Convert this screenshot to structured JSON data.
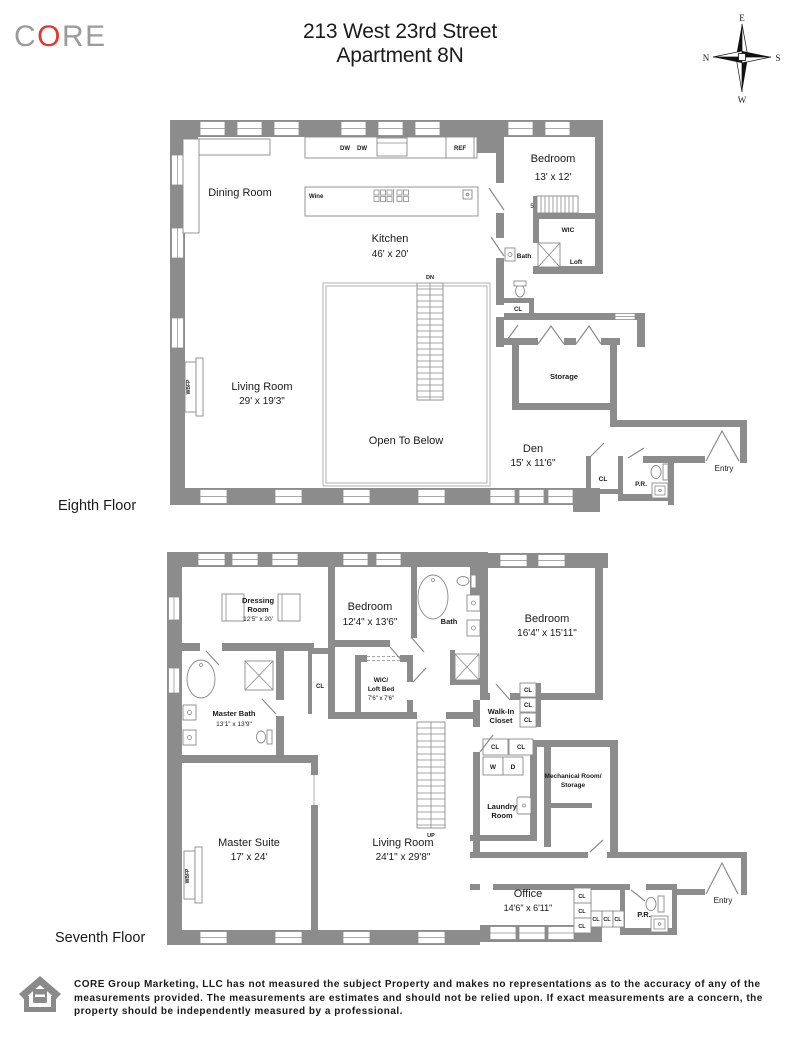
{
  "header": {
    "logo": {
      "c": "C",
      "o": "O",
      "re": "RE"
    },
    "title_line1": "213 West 23rd Street",
    "title_line2": "Apartment 8N",
    "compass": {
      "top": "E",
      "left": "N",
      "right": "S",
      "bottom": "W"
    }
  },
  "colors": {
    "logo_red": "#e0382e",
    "logo_gray": "#9b9b9b",
    "wall_gray": "#8c8c8c"
  },
  "floor8": {
    "name": "Eighth Floor",
    "dining": "Dining Room",
    "kitchen": "Kitchen",
    "kitchen_dims": "46' x 20'",
    "bedroom": "Bedroom",
    "bedroom_dims": "13' x 12'",
    "living": "Living Room",
    "living_dims": "29' x 19'3\"",
    "open_to_below": "Open To Below",
    "den": "Den",
    "den_dims": "15' x 11'6\"",
    "storage": "Storage",
    "wic": "WIC",
    "bath": "Bath",
    "loft": "Loft",
    "cl": "CL",
    "pr": "P.R.",
    "entry": "Entry",
    "dw": "DW",
    "ref": "REF",
    "wine": "Wine",
    "dn": "DN",
    "steps": "5",
    "wbfp": "WBFP"
  },
  "floor7": {
    "name": "Seventh Floor",
    "dressing_line1": "Dressing",
    "dressing_line2": "Room",
    "dressing_dims": "12'5\" x 20'",
    "master_bath": "Master Bath",
    "master_bath_dims": "13'1\" x 13'9\"",
    "bedroom_mid": "Bedroom",
    "bedroom_mid_dims": "12'4\" x 13'6\"",
    "wic_line1": "WIC/",
    "wic_line2": "Loft Bed",
    "wic_dims": "7'6\" x 7'6\"",
    "bath": "Bath",
    "bedroom_right": "Bedroom",
    "bedroom_right_dims": "16'4\" x 15'11\"",
    "walk_in_line1": "Walk-In",
    "walk_in_line2": "Closet",
    "cl": "CL",
    "w": "W",
    "d": "D",
    "laundry_line1": "Laundry",
    "laundry_line2": "Room",
    "mech_line1": "Mechanical Room/",
    "mech_line2": "Storage",
    "master_suite": "Master Suite",
    "master_suite_dims": "17' x 24'",
    "living": "Living Room",
    "living_dims": "24'1\" x 29'8\"",
    "office": "Office",
    "office_dims": "14'6\" x 6'11\"",
    "pr": "P.R.",
    "entry": "Entry",
    "up": "UP",
    "wbfp": "WBFP"
  },
  "footer": {
    "disclaimer": "CORE Group Marketing, LLC has not measured the subject Property and makes no representations as to the accuracy of any of the measurements provided. The measurements are estimates and should not be relied upon. If exact measurements are a concern, the property should be independently measured by a professional."
  }
}
